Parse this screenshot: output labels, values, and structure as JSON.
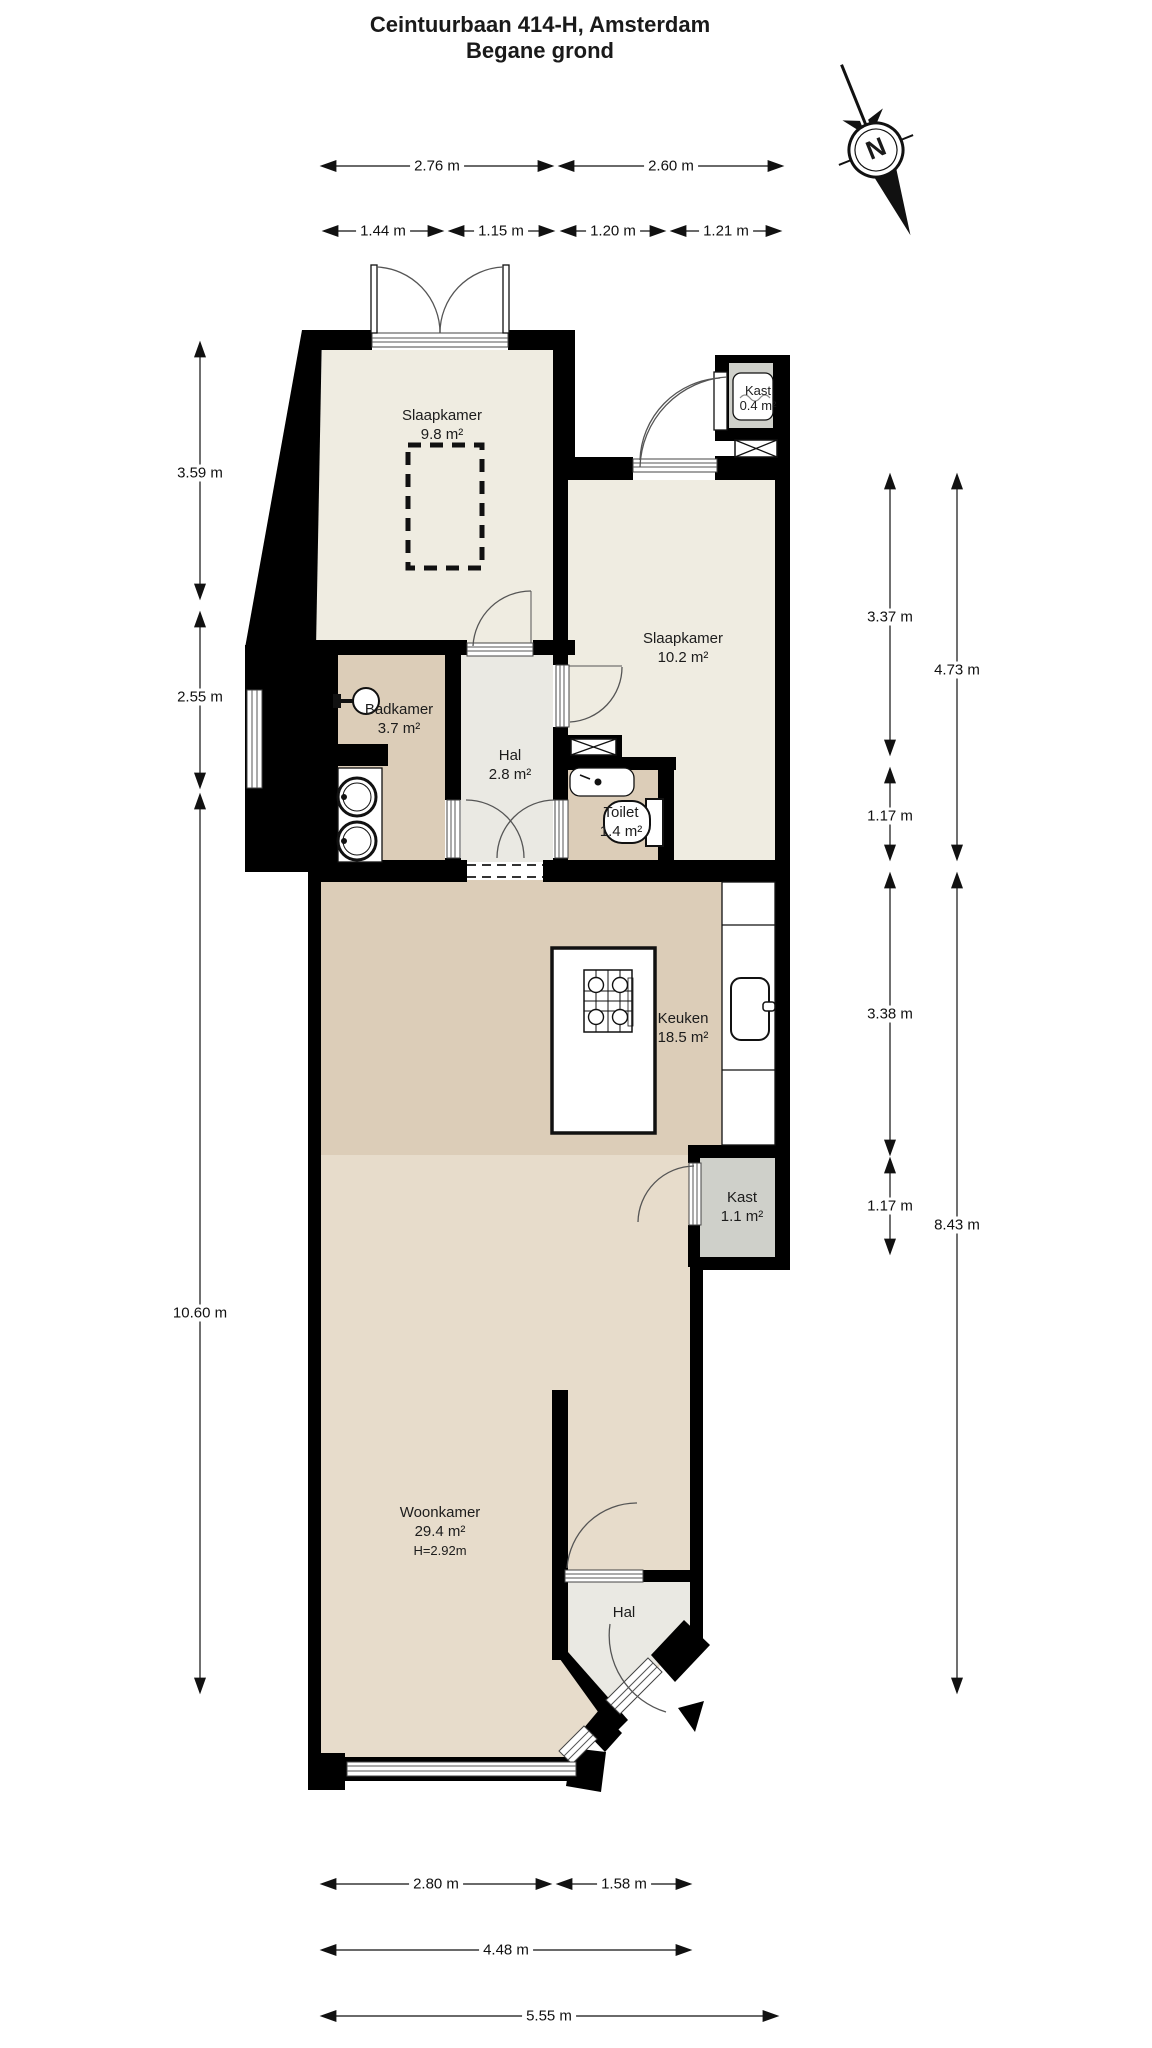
{
  "title": {
    "line1": "Ceintuurbaan 414-H, Amsterdam",
    "line2": "Begane grond"
  },
  "compass": {
    "north_label": "N"
  },
  "rooms": {
    "slaapkamer_1": {
      "name": "Slaapkamer",
      "area": "9.8 m²"
    },
    "kast_boiler": {
      "name": "Kast",
      "area": "0.4 m²"
    },
    "slaapkamer_2": {
      "name": "Slaapkamer",
      "area": "10.2 m²"
    },
    "badkamer": {
      "name": "Badkamer",
      "area": "3.7 m²"
    },
    "hal": {
      "name": "Hal",
      "area": "2.8 m²"
    },
    "toilet": {
      "name": "Toilet",
      "area": "1.4 m²"
    },
    "keuken": {
      "name": "Keuken",
      "area": "18.5 m²"
    },
    "kast": {
      "name": "Kast",
      "area": "1.1 m²"
    },
    "woonkamer": {
      "name": "Woonkamer",
      "area": "29.4 m²",
      "ceiling_height": "H=2.92m"
    },
    "hal_entree": {
      "name": "Hal"
    }
  },
  "dimensions": {
    "top_row_1": [
      "2.76 m",
      "2.60 m"
    ],
    "top_row_2": [
      "1.44 m",
      "1.15 m",
      "1.20 m",
      "1.21 m"
    ],
    "left": [
      "3.59 m",
      "2.55 m",
      "10.60 m"
    ],
    "right_inner": [
      "3.37 m",
      "1.17 m",
      "3.38 m",
      "1.17 m"
    ],
    "right_outer": [
      "4.73 m",
      "8.43 m"
    ],
    "bottom_row_1": [
      "2.80 m",
      "1.58 m"
    ],
    "bottom_row_2": [
      "4.48 m"
    ],
    "bottom_row_3": [
      "5.55 m"
    ]
  },
  "colors": {
    "wall": "#000000",
    "floor_cream": "#efece1",
    "floor_tan": "#dccdb8",
    "floor_tan_light": "#e7dccb",
    "floor_hal": "#eae9e3",
    "closet_gray": "#cfd0ca"
  }
}
